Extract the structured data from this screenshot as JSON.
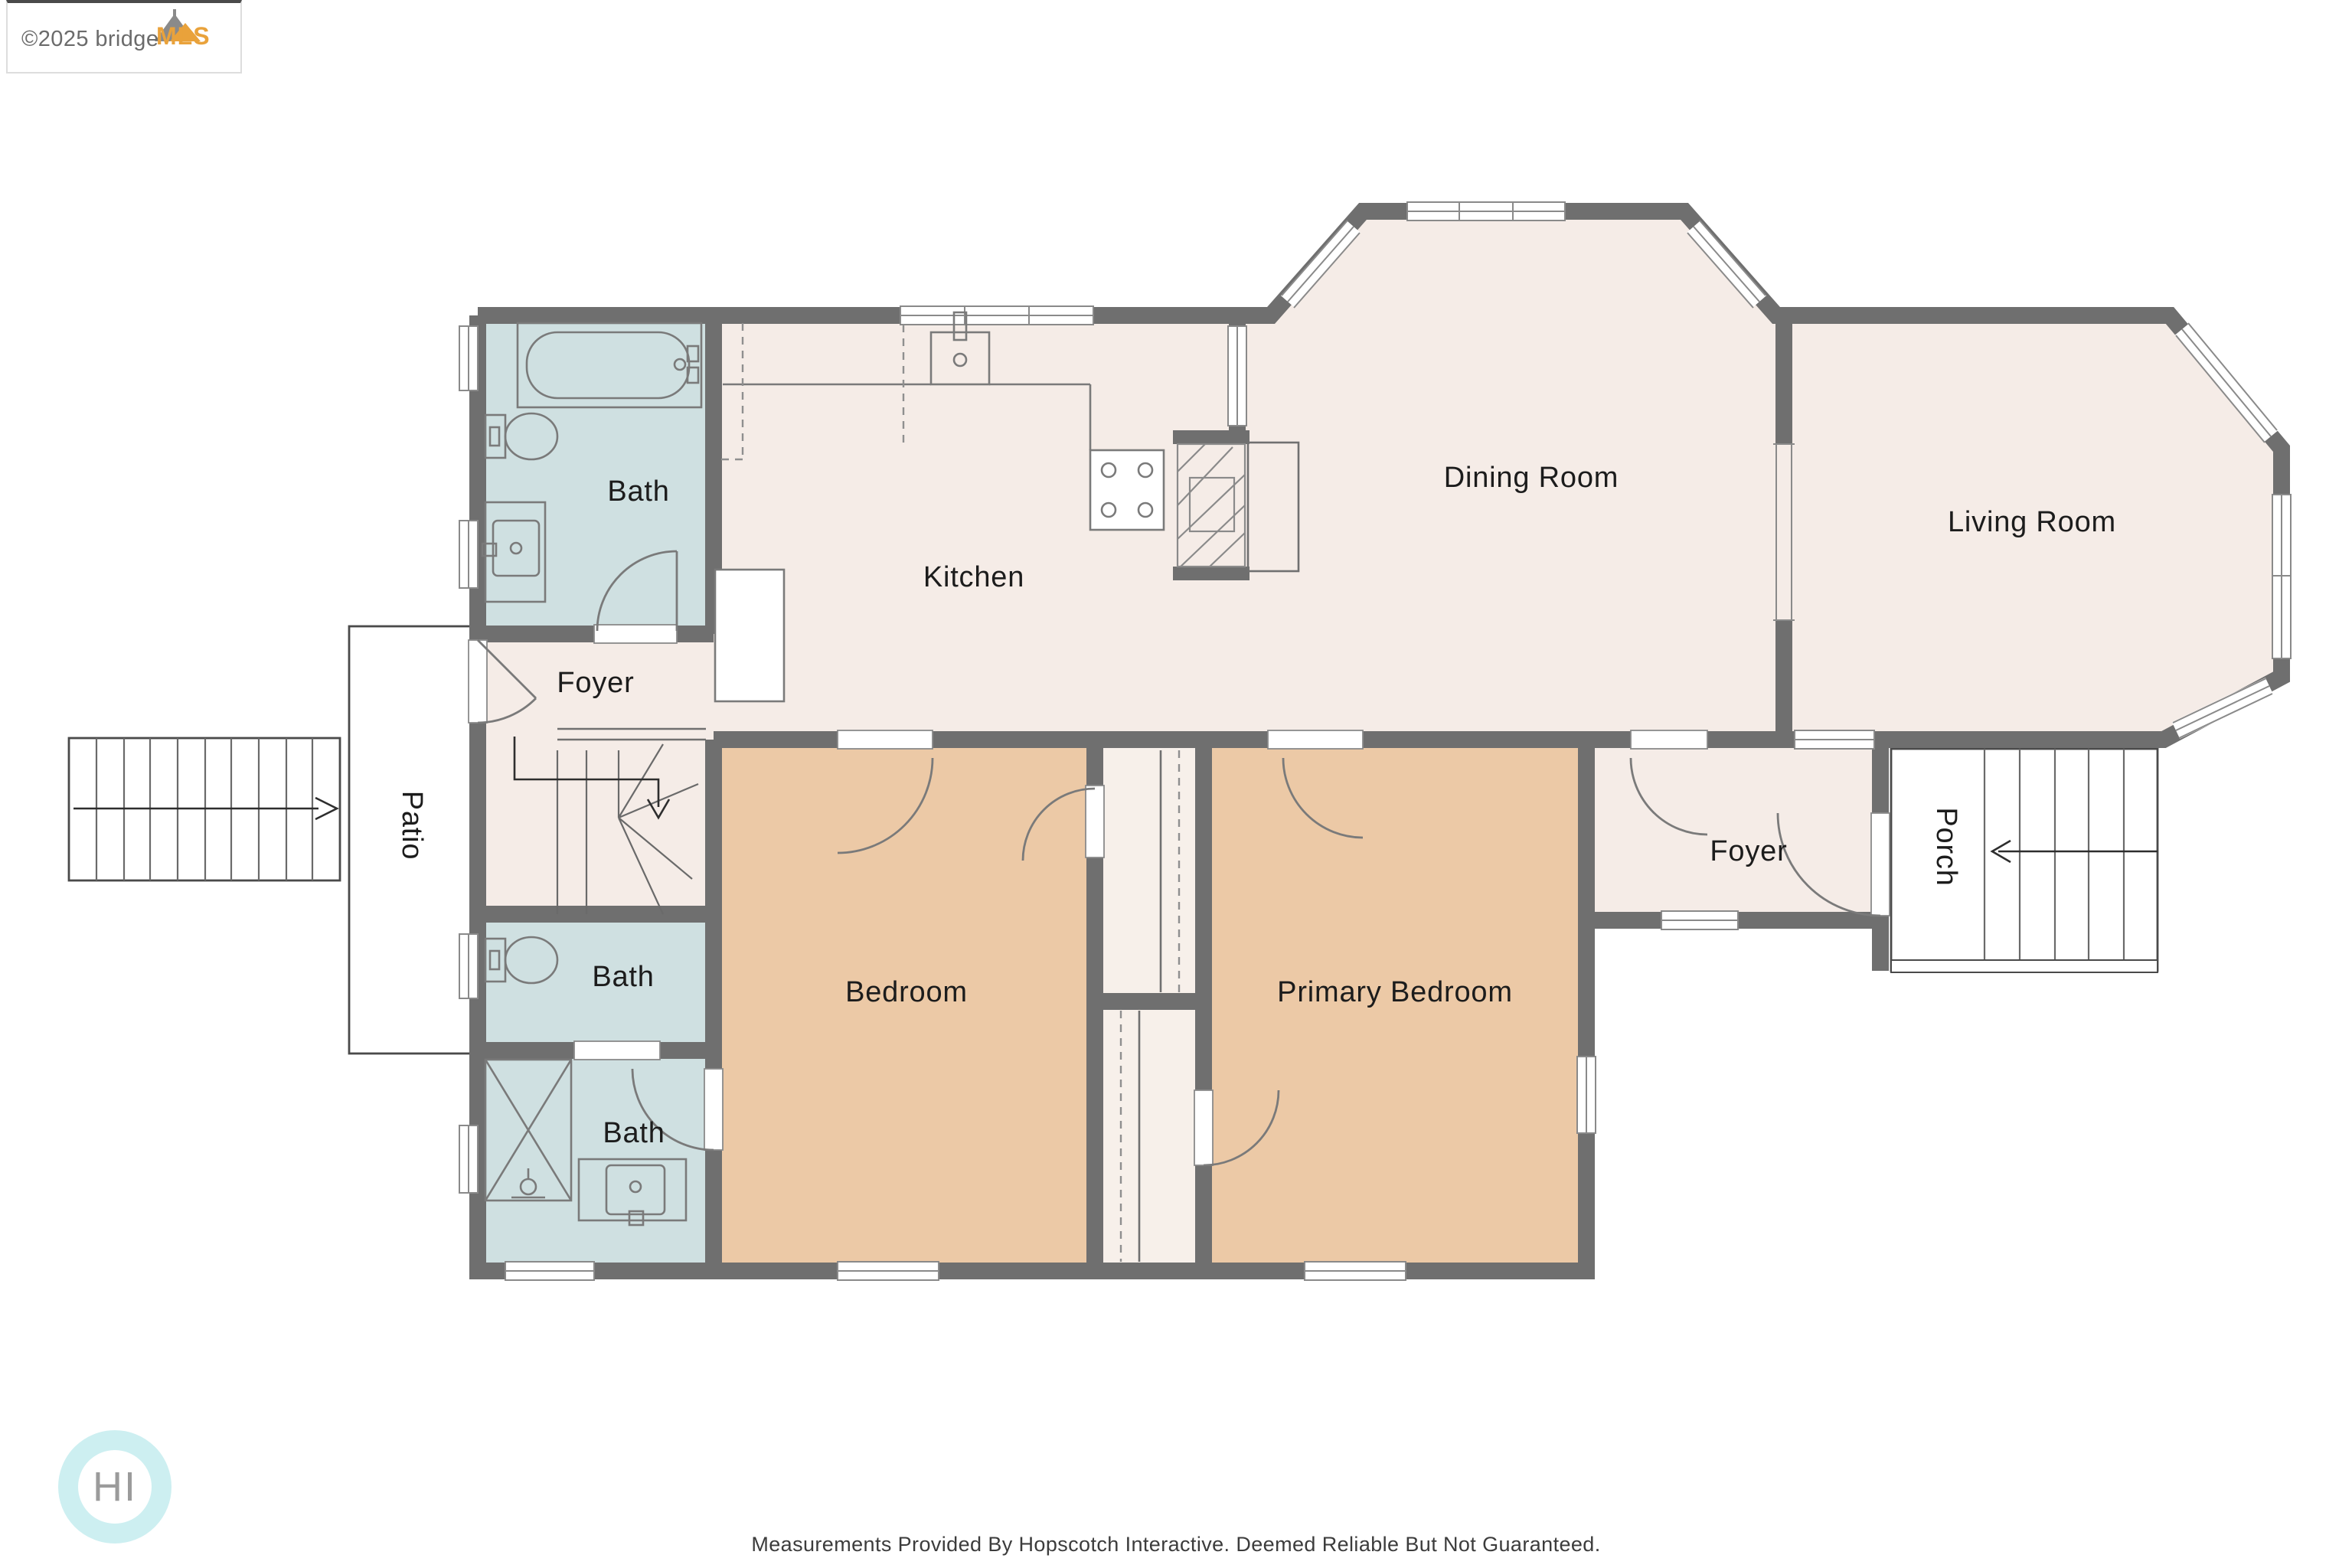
{
  "watermark": {
    "copyright": "©2025 bridge",
    "brand": "MLS"
  },
  "logo": {
    "text": "HI"
  },
  "footer": {
    "disclaimer": "Measurements Provided By Hopscotch Interactive. Deemed Reliable But Not Guaranteed."
  },
  "rooms": {
    "bath_top": "Bath",
    "kitchen": "Kitchen",
    "dining_room": "Dining Room",
    "living_room": "Living Room",
    "foyer_main": "Foyer",
    "patio": "Patio",
    "bath_middle": "Bath",
    "bath_bottom": "Bath",
    "bedroom": "Bedroom",
    "primary_bedroom": "Primary Bedroom",
    "foyer_entry": "Foyer",
    "porch": "Porch"
  },
  "colors": {
    "wall": "#6f6f6f",
    "floor": "#f5ece7",
    "bath": "#cfe0e1",
    "bedroom": "#ecc9a6",
    "outdoor": "#ededed"
  }
}
